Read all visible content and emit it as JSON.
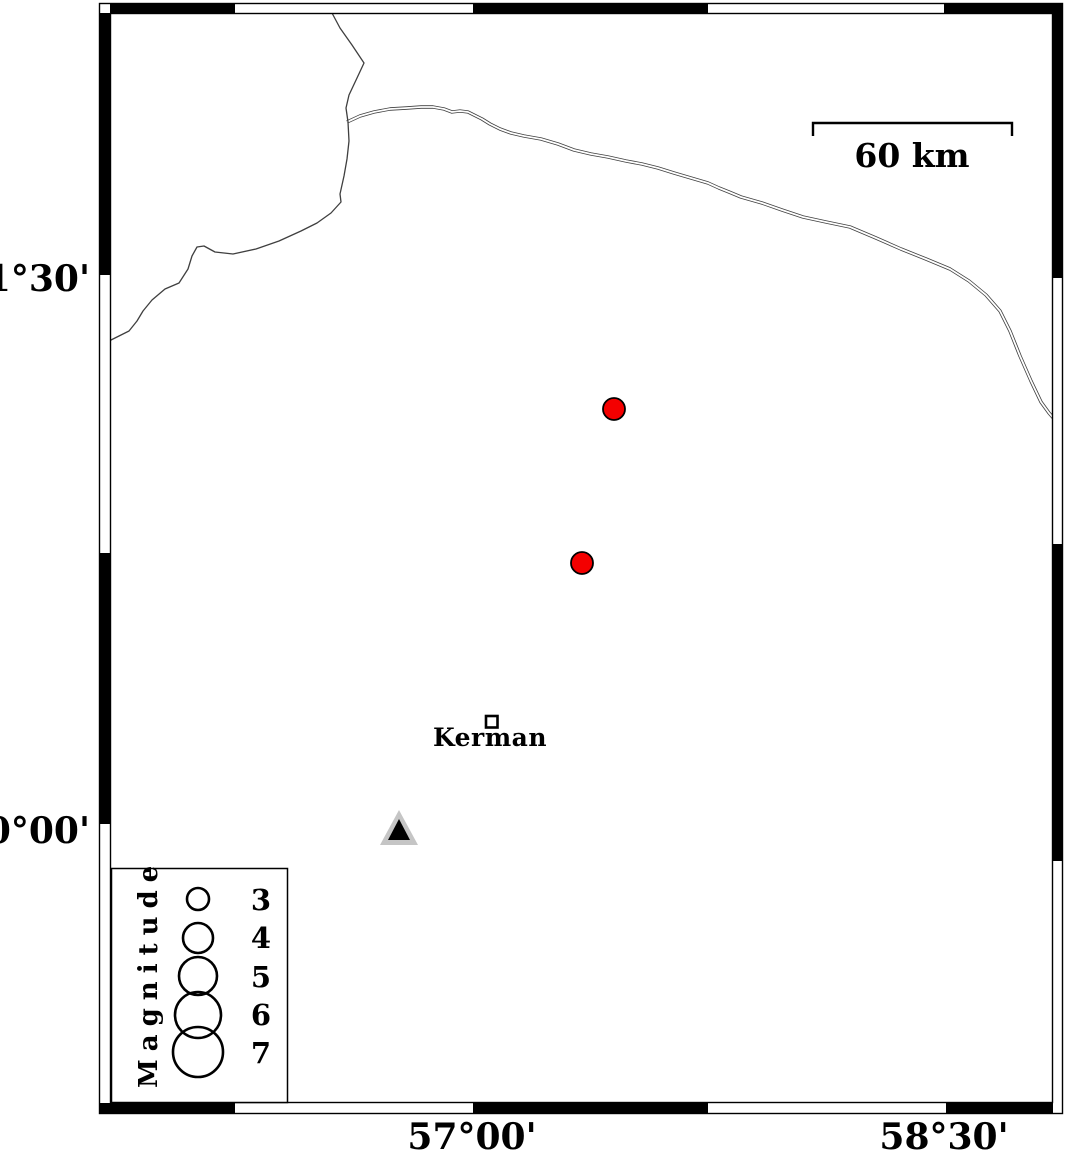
{
  "axis": {
    "left": [
      "31°30'",
      "30°00'"
    ],
    "bottom": [
      "57°00'",
      "58°30'"
    ]
  },
  "scale_bar": {
    "label": "60 km",
    "length_km": 60
  },
  "city": {
    "label": "Kerman"
  },
  "legend": {
    "title": "Magnitude",
    "sizes": [
      "3",
      "4",
      "5",
      "6",
      "7"
    ]
  },
  "map_data": {
    "epicenters": [
      {
        "symbol": "circle",
        "color": "red",
        "approx_lon_deg": 57.45,
        "approx_lat_deg": 31.13,
        "magnitude_from_symbol_size": 3
      },
      {
        "symbol": "circle",
        "color": "red",
        "approx_lon_deg": 57.35,
        "approx_lat_deg": 30.72,
        "magnitude_from_symbol_size": 3
      }
    ],
    "station": {
      "symbol": "triangle",
      "approx_lon_deg": 56.76,
      "approx_lat_deg": 30.0
    },
    "city_marker": {
      "symbol": "open-square",
      "approx_lon_deg": 57.06,
      "approx_lat_deg": 30.29
    }
  },
  "colors": {
    "epicenter_fill": "#f40000",
    "station_outer": "#c5c5c5",
    "station_inner": "#000000",
    "line": "#3f3f3f",
    "frame": "#000000"
  }
}
